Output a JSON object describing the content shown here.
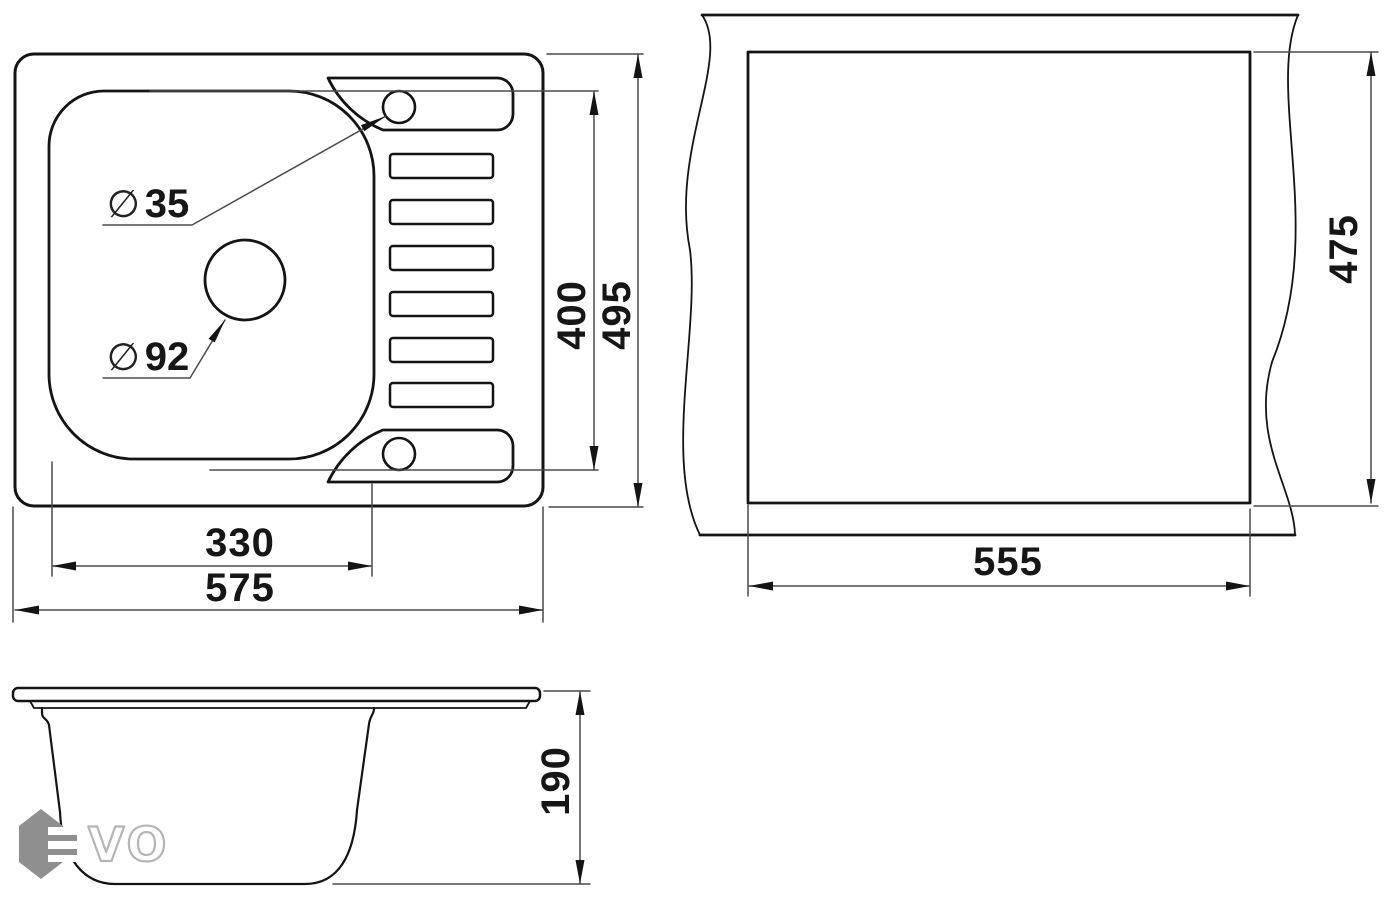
{
  "drawing": {
    "plan_view": {
      "bowl_width": "330",
      "overall_width": "575",
      "bowl_length": "400",
      "overall_length": "495",
      "faucet_hole": {
        "symbol": "∅",
        "value": "35"
      },
      "drain_hole": {
        "symbol": "∅",
        "value": "92"
      }
    },
    "cutout_view": {
      "cutout_width": "555",
      "cutout_length": "475"
    },
    "side_view": {
      "depth": "190"
    }
  },
  "logo": {
    "text": "VO"
  },
  "colors": {
    "line": "#141414",
    "thin_line": "#4a4a4a",
    "logo_gray": "#8f8f8f",
    "logo_outline": "#b5b5b5"
  }
}
